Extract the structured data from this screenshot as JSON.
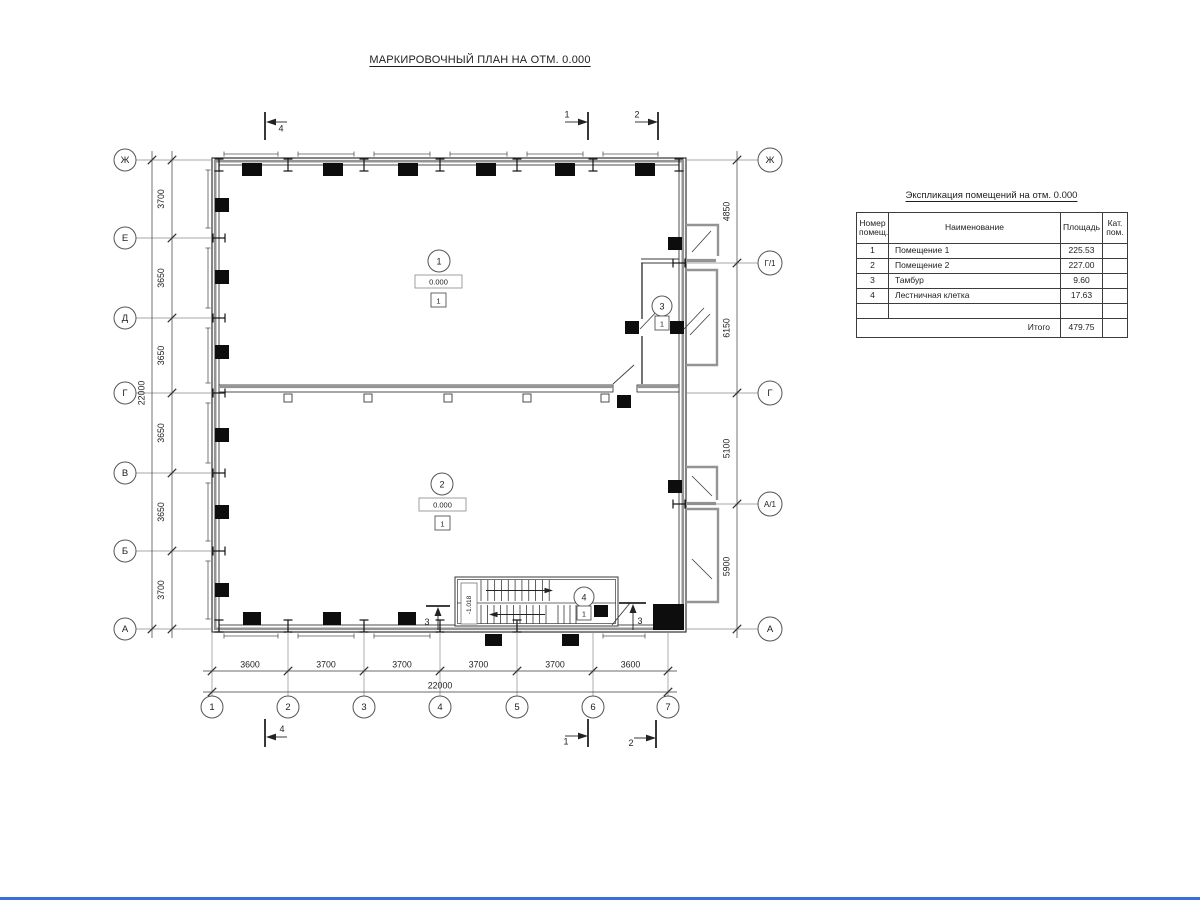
{
  "title": "МАРКИРОВОЧНЫЙ ПЛАН НА ОТМ. 0.000",
  "colors": {
    "line": "#3a3a3a",
    "wall_accent": "#949494",
    "column_fill": "#0d0d0d"
  },
  "axes": {
    "left": [
      "Ж",
      "Е",
      "Д",
      "Г",
      "В",
      "Б",
      "А"
    ],
    "right": [
      "Ж",
      "Г/1",
      "Г",
      "А/1",
      "А"
    ],
    "bottom": [
      "1",
      "2",
      "3",
      "4",
      "5",
      "6",
      "7"
    ]
  },
  "dims": {
    "left_segments": [
      "3700",
      "3650",
      "3650",
      "3650",
      "3650",
      "3700"
    ],
    "left_total": "22000",
    "right_segments": [
      "4850",
      "6150",
      "5100",
      "5900"
    ],
    "bottom_segments": [
      "3600",
      "3700",
      "3700",
      "3700",
      "3700",
      "3600"
    ],
    "bottom_total": "22000"
  },
  "rooms": [
    {
      "number": "1",
      "elevation": "0.000",
      "floor_mark": "1"
    },
    {
      "number": "2",
      "elevation": "0.000",
      "floor_mark": "1"
    },
    {
      "number": "3",
      "floor_mark": "1"
    },
    {
      "number": "4",
      "floor_mark": "1"
    }
  ],
  "stair": {
    "elevation_label": "-1.018"
  },
  "sections": {
    "s1": "1",
    "s2": "2",
    "s3": "3",
    "s4": "4"
  },
  "explication": {
    "title": "Экспликация помещений на отм. 0.000",
    "headers": {
      "num": "Номер\nпомещ.",
      "name": "Наименование",
      "area": "Площадь",
      "cat": "Кат.\nпом."
    },
    "rows": [
      {
        "num": "1",
        "name": "Помещение 1",
        "area": "225.53",
        "cat": ""
      },
      {
        "num": "2",
        "name": "Помещение 2",
        "area": "227.00",
        "cat": ""
      },
      {
        "num": "3",
        "name": "Тамбур",
        "area": "9.60",
        "cat": ""
      },
      {
        "num": "4",
        "name": "Лестничная клетка",
        "area": "17.63",
        "cat": ""
      },
      {
        "num": "",
        "name": "",
        "area": "",
        "cat": ""
      }
    ],
    "total_label": "Итого",
    "total_value": "479.75"
  }
}
